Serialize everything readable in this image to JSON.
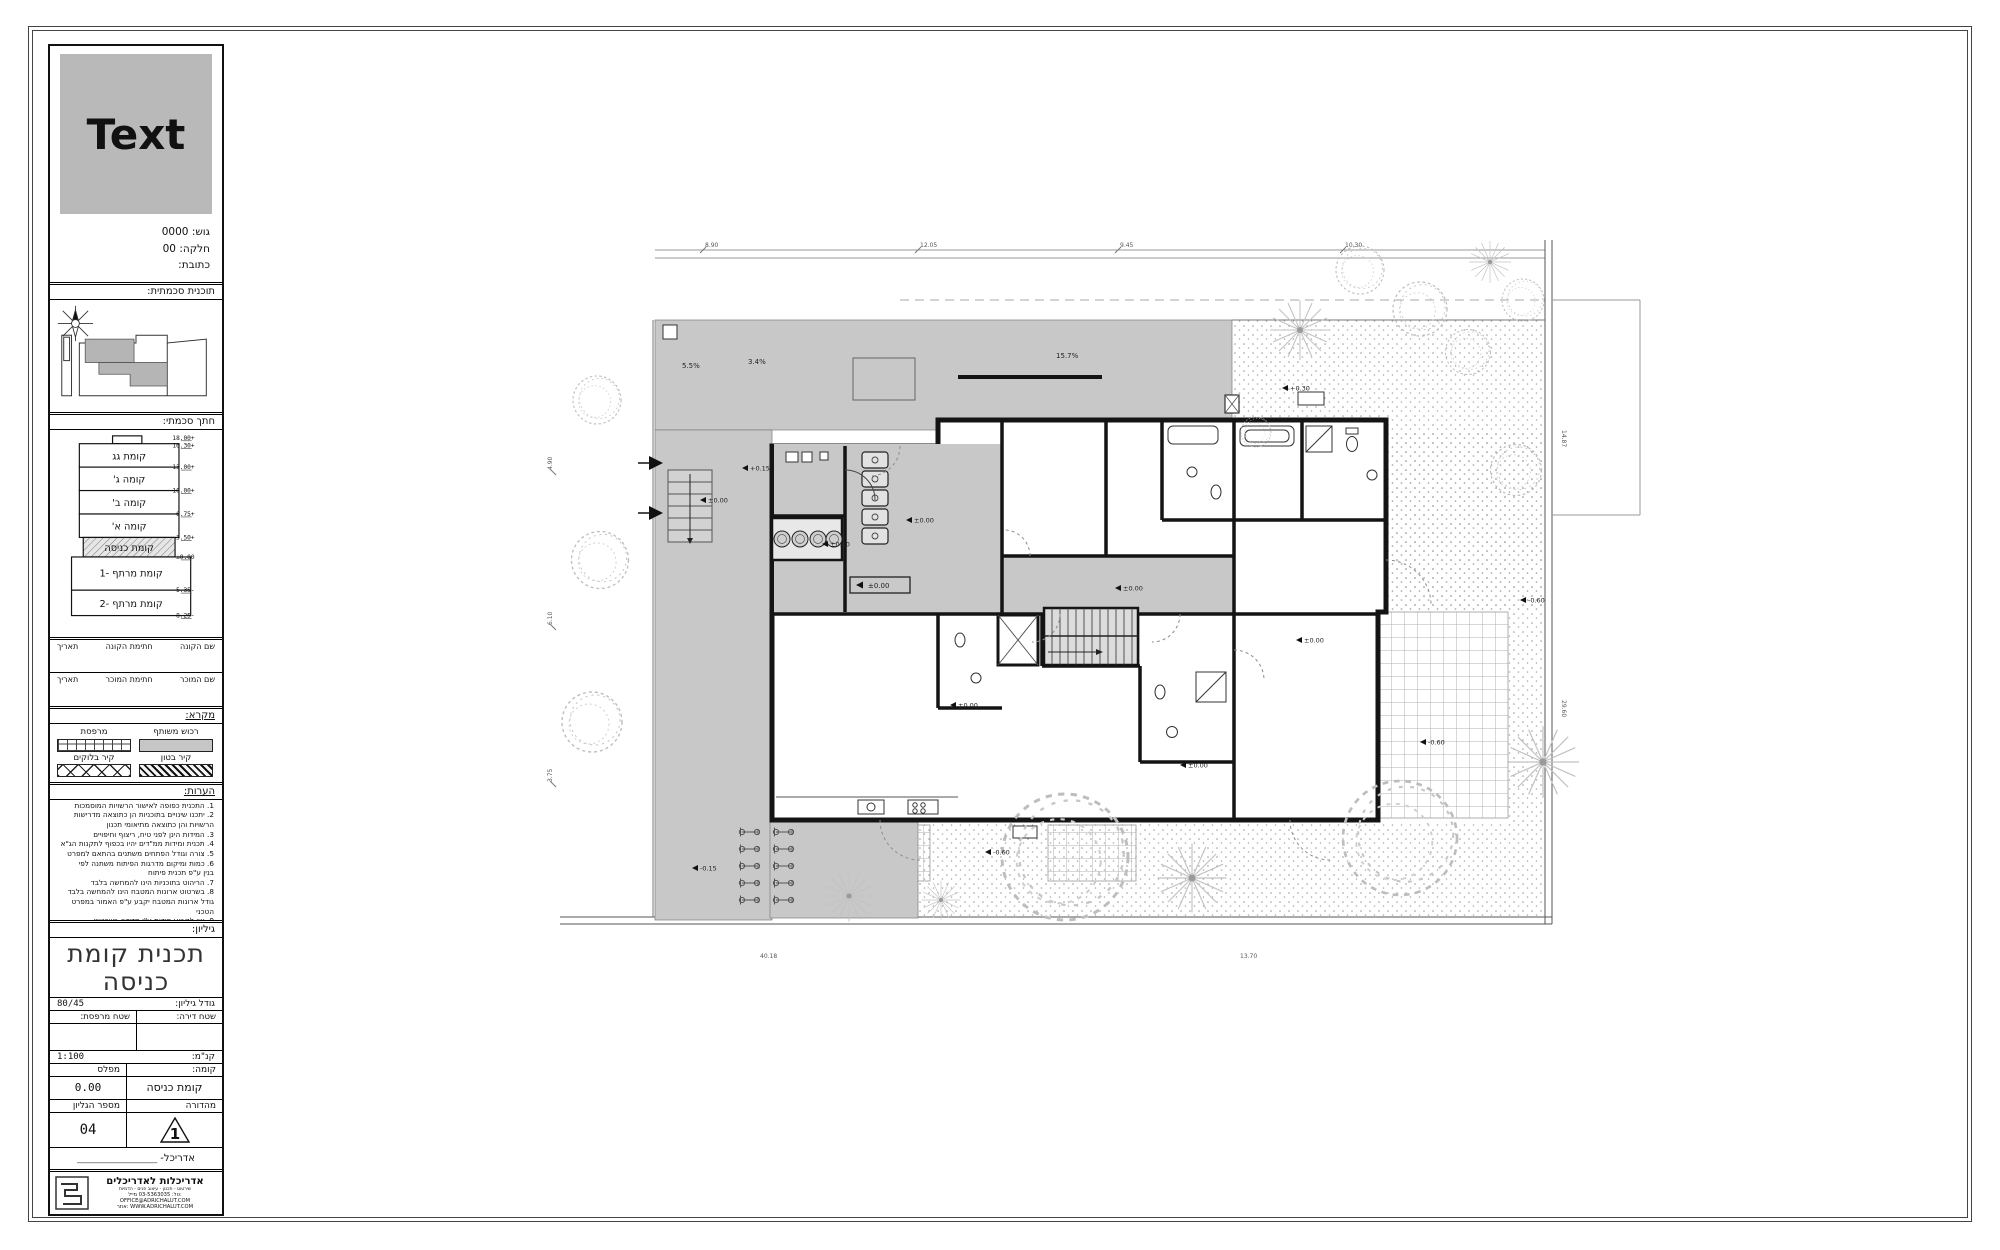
{
  "sidebar": {
    "logo_text": "Text",
    "info": {
      "gush": "גוש: 0000",
      "helka": "חלקה: 00",
      "address": "כתובת:"
    },
    "headers": {
      "keyplan": "תוכנית סכמתית:",
      "section": "חתך סכמתי:",
      "legend": "מקרא:",
      "notes": "הערות:",
      "sheet": "גיליון:"
    },
    "section": {
      "floors": [
        {
          "label": "קומת גג"
        },
        {
          "label": "קומה ג'"
        },
        {
          "label": "קומה ב'"
        },
        {
          "label": "קומה א'"
        },
        {
          "label": "קומת כניסה"
        },
        {
          "label": "קומת מרתף -1"
        },
        {
          "label": "קומת מרתף -2"
        }
      ],
      "elevations": [
        "+18.00",
        "+16.30",
        "+13.00",
        "+10.00",
        "+6.75",
        "+3.50",
        "±0.00",
        "-5.35",
        "-8.25"
      ]
    },
    "signatures": {
      "buyer_name": "שם הקונה",
      "buyer_sign": "חתימת הקונה",
      "date1": "תאריך",
      "seller_name": "שם המוכר",
      "seller_sign": "חתימת המוכר",
      "date2": "תאריך"
    },
    "legend": {
      "shared": "רכוש משותף",
      "balcony": "מרפסת",
      "concrete": "קיר בטון",
      "blocks": "קיר בלוקים"
    },
    "notes_lines": [
      "1. התכנית כפופה לאישור הרשויות המוסמכות",
      "2. יתכנו שינויים בתוכניות הן כתוצאה מדרישות",
      "הרשויות והן כתוצאה מתיאומי תכנון",
      "3. המידות הינן לפני טיח, ריצוף וחיפויים",
      "4. תכנית ומידות ממ\"דים יהיו בכפוף לתקנות הג\"א",
      "5. צורה וגודל הפתחים משתנים בהתאם למפרט",
      "6. כמות ומיקום מדרגות הפיתוח משתנה לפי",
      "בנין ע\"פ תכנית פיתוח",
      "7. הריהוט בתוכניות הינו להמחשה בלבד",
      "8. בשרטוט ארונות המטבח הינו להמחשה בלבד",
      "גודל ארונות המטבח יקבע ע\"פ האמור במפרט הטכני",
      "9. אין לקבוע מידות ע\"י מדידה בשרטוט",
      "אלא להתאים למידות הרשומות בלבד"
    ],
    "titleblock": {
      "title_line1": "תכנית קומת",
      "title_line2": "כניסה",
      "size_label": "גודל גיליון:",
      "size_value": "80/45",
      "apt_area_label": "שטח דירה:",
      "balcony_area_label": "שטח מרפסת:",
      "scale_label": "קנ\"מ:",
      "scale_value": "1:100",
      "floor_label": "קומה:",
      "level_label": "מפלס",
      "floor_value": "קומת כניסה",
      "level_value": "0.00",
      "edition_label": "מהדורה",
      "sheet_no_label": "מספר הגליון",
      "edition_value": "1",
      "sheet_no_value": "04",
      "architect_label": "אדריכל-",
      "architect_line": "________________"
    },
    "footer": {
      "firm": "אדריכלות לאדריכלים",
      "services": "שירטוט - תכנון - עיצוב פנים - הדמיות",
      "contact": "טל: 03-5363035   מייל: OFFICE@ADRICHALUT.COM",
      "web": "אתר: WWW.ADRICHALUT.COM"
    }
  },
  "plan": {
    "slopes": [
      "5.5%",
      "3.4%",
      "15.7%"
    ],
    "lobby_level": "±0.00",
    "markers": [
      "±0.00",
      "±0.00",
      "+0.15",
      "±0.00",
      "±0.00",
      "±0.00",
      "±0.00",
      "±0.00",
      "-0.60",
      "-0.60",
      "+0.30",
      "-0.15",
      "-0.60"
    ],
    "dims_top": [
      "8.90",
      "12.05",
      "9.45",
      "10.30"
    ],
    "dims_bottom": [
      "40.18",
      "13.70"
    ],
    "dims_left": [
      "4.90",
      "6.10",
      "3.75"
    ],
    "dims_right": [
      "14.87",
      "29.60"
    ]
  }
}
